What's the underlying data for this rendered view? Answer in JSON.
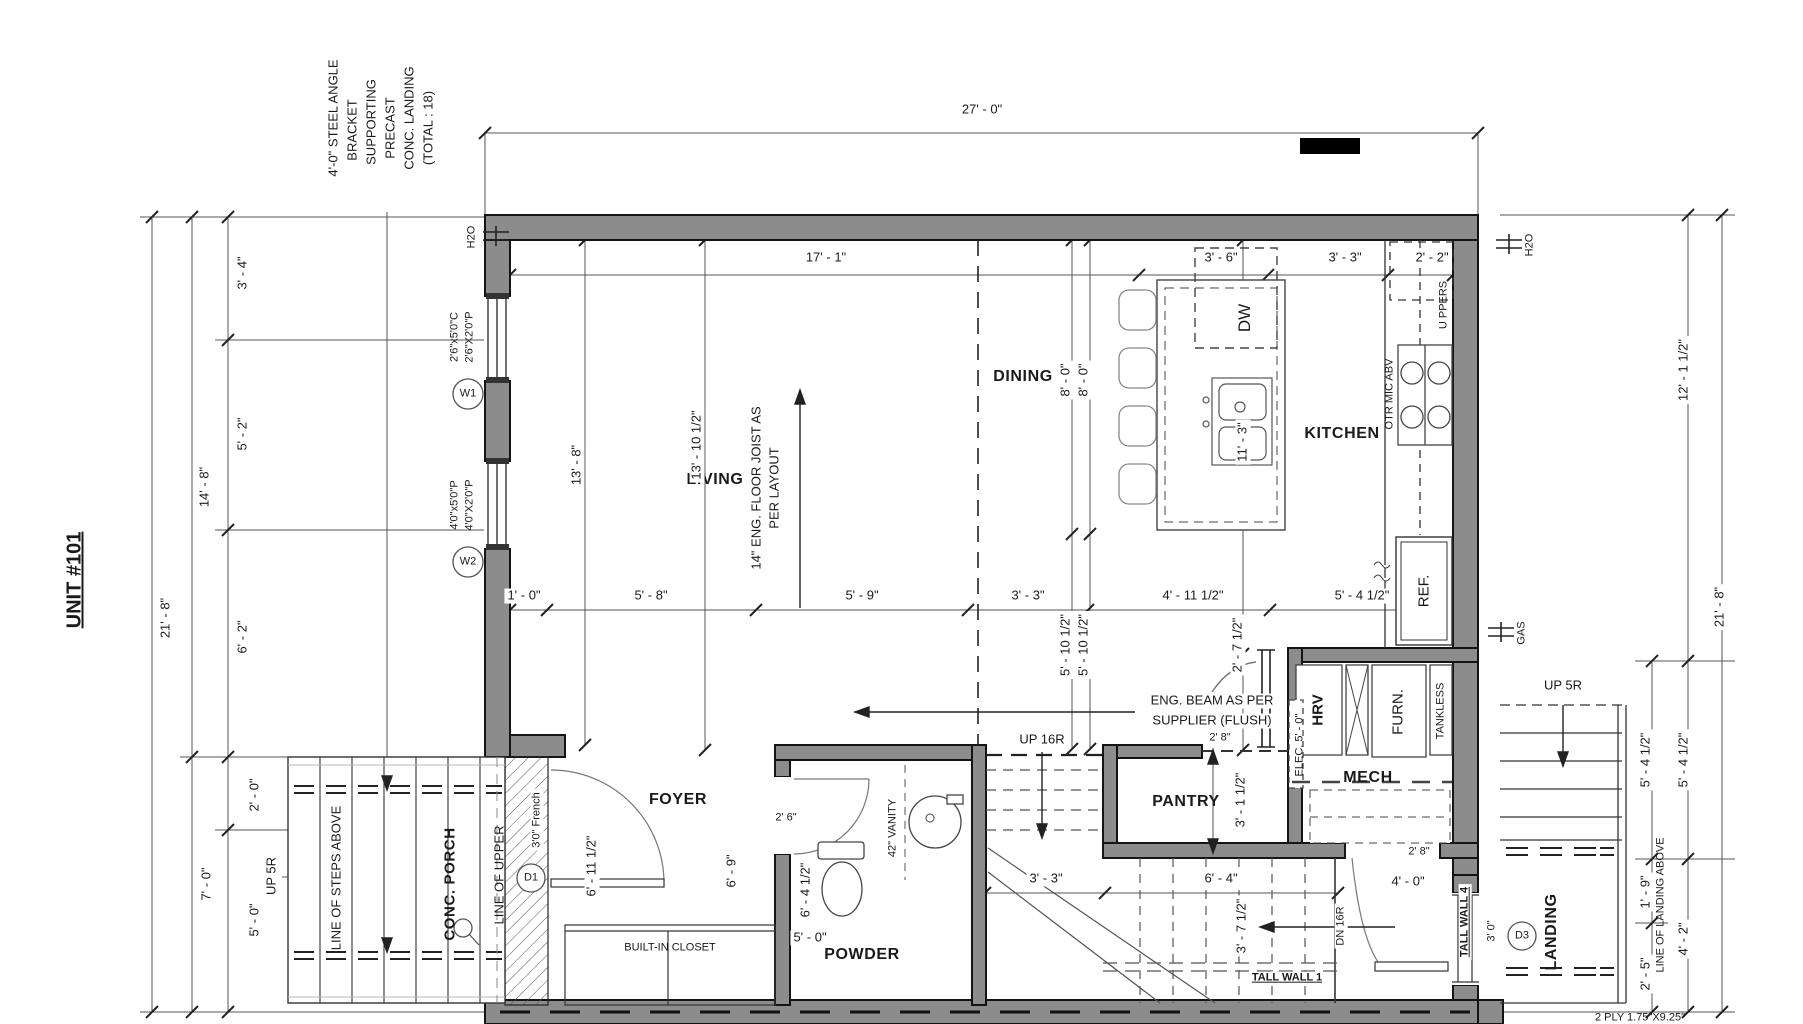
{
  "unit_label": "UNIT #101",
  "steel_note": [
    "4'-0\" STEEL ANGLE",
    "BRACKET",
    "SUPPORTING",
    "PRECAST",
    "CONC. LANDING",
    "(TOTAL : 18)"
  ],
  "rooms": {
    "living": "LIVING",
    "dining": "DINING",
    "kitchen": "KITCHEN",
    "foyer": "FOYER",
    "powder": "POWDER",
    "pantry": "PANTRY",
    "mech": "MECH",
    "landing": "LANDING",
    "porch": "CONC. PORCH"
  },
  "fixtures": {
    "dw": "DW",
    "ref": "REF.",
    "hrv": "HRV",
    "furnace": "FURN.",
    "tankless": "TANKLESS",
    "uppers": "U PPERS",
    "otr": "OTR MIC ABV",
    "elec": "ELEC. 5' - 0\"",
    "vanity": "42\" VANITY",
    "closet": "BUILT-IN CLOSET"
  },
  "stairs": {
    "up16r": "UP 16R",
    "dn16r": "DN 16R",
    "up5r_left": "UP 5R",
    "up5r_right": "UP 5R",
    "tall_wall_1": "TALL WALL 1",
    "tall_wall_4": "TALL WALL 4"
  },
  "ref_lines": {
    "steps_above": "LINE OF STEPS ABOVE",
    "upper": "LINE OF UPPER",
    "landing_above": "LINE OF LANDING ABOVE"
  },
  "notes": {
    "eng_beam_1": "ENG. BEAM AS PER",
    "eng_beam_2": "SUPPLIER (FLUSH)",
    "joist_1": "14\" ENG. FLOOR JOIST AS",
    "joist_2": "PER LAYOUT",
    "ply": "2 PLY 1.75\"X9.25\""
  },
  "services": {
    "h2o_left": "H2O",
    "h2o_right": "H2O",
    "gas": "GAS"
  },
  "windows": {
    "w1_tag": "W1",
    "w1_spec_1": "2'6\"x5'0\"C",
    "w1_spec_2": "2'6\"X2'0\"P",
    "w2_tag": "W2",
    "w2_spec_1": "4'0\"x5'0\"P",
    "w2_spec_2": "4'0\"X2'0\"P"
  },
  "doors": {
    "d1_tag": "D1",
    "d1_size": "3'0\" French",
    "d3_tag": "D3",
    "d3_size": "3' 0\"",
    "powder_size": "2' 6\"",
    "pantry_size": "2' 8\"",
    "mech_size": "2' 8\"",
    "mech_swing": "4' - 0\""
  },
  "dims": {
    "top_overall": "27' - 0\"",
    "top_a": "17' - 1\"",
    "top_b": "3' - 6\"",
    "top_c": "3' - 3\"",
    "top_d": "2' - 2\"",
    "left_overall": "21' - 8\"",
    "left_mid": "14' - 8\"",
    "left_1": "3' - 4\"",
    "left_2": "5' - 2\"",
    "left_3": "6' - 2\"",
    "left_4": "2' - 0\"",
    "left_5": "7' - 0\"",
    "left_6": "5' - 0\"",
    "mid_1": "1' - 0\"",
    "mid_2": "5' - 8\"",
    "mid_3": "5' - 9\"",
    "mid_4": "3' - 3\"",
    "mid_5": "4' - 11 1/2\"",
    "mid_6": "5' - 4 1/2\"",
    "living_a": "13' - 8\"",
    "living_b": "13' - 10 1/2\"",
    "dining_a": "8' - 0\"",
    "dining_b": "8' - 0\"",
    "island": "11' - 3\"",
    "stair_a": "5' - 10 1/2\"",
    "stair_b": "5' - 10 1/2\"",
    "beam_off": "2' - 7 1/2\"",
    "pantry_d": "3' - 1 1/2\"",
    "stair_c": "3' - 3\"",
    "stair_d": "6' - 4\"",
    "stair_e": "3' - 7 1/2\"",
    "foyer_a": "6' - 11 1/2\"",
    "foyer_b": "6' - 9\"",
    "foyer_c": "6' - 4 1/2\"",
    "powder_t": "5' - 0\"",
    "right_mid": "12' - 1 1/2\"",
    "right_overall": "21' - 8\"",
    "right_1": "5' - 4 1/2\"",
    "right_2": "5' - 4 1/2\"",
    "right_3": "1' - 9\"",
    "right_4": "4' - 2\"",
    "right_5": "2' - 5\""
  }
}
